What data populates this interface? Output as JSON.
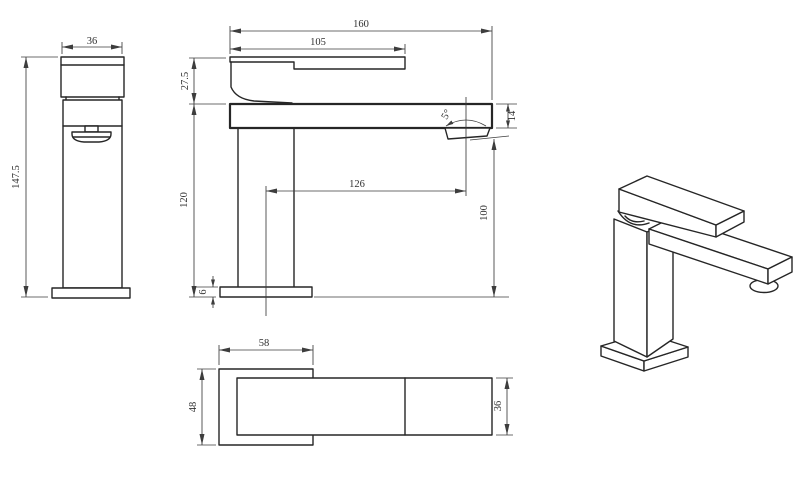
{
  "colors": {
    "background": "#ffffff",
    "object_lines": "#262626",
    "dimension_lines": "#3d3d3d",
    "dimension_text": "#303030"
  },
  "front_view": {
    "width_top": "36",
    "overall_height": "147.5"
  },
  "side_view": {
    "overall_length": "160",
    "handle_length": "105",
    "upper_height": "27.5",
    "spout_angle": "5°",
    "spout_thickness": "14",
    "spout_reach": "126",
    "body_height": "120",
    "outlet_height": "100",
    "base_thickness": "6"
  },
  "plan_view": {
    "base_width": "58",
    "base_depth": "48",
    "spout_width": "36"
  }
}
